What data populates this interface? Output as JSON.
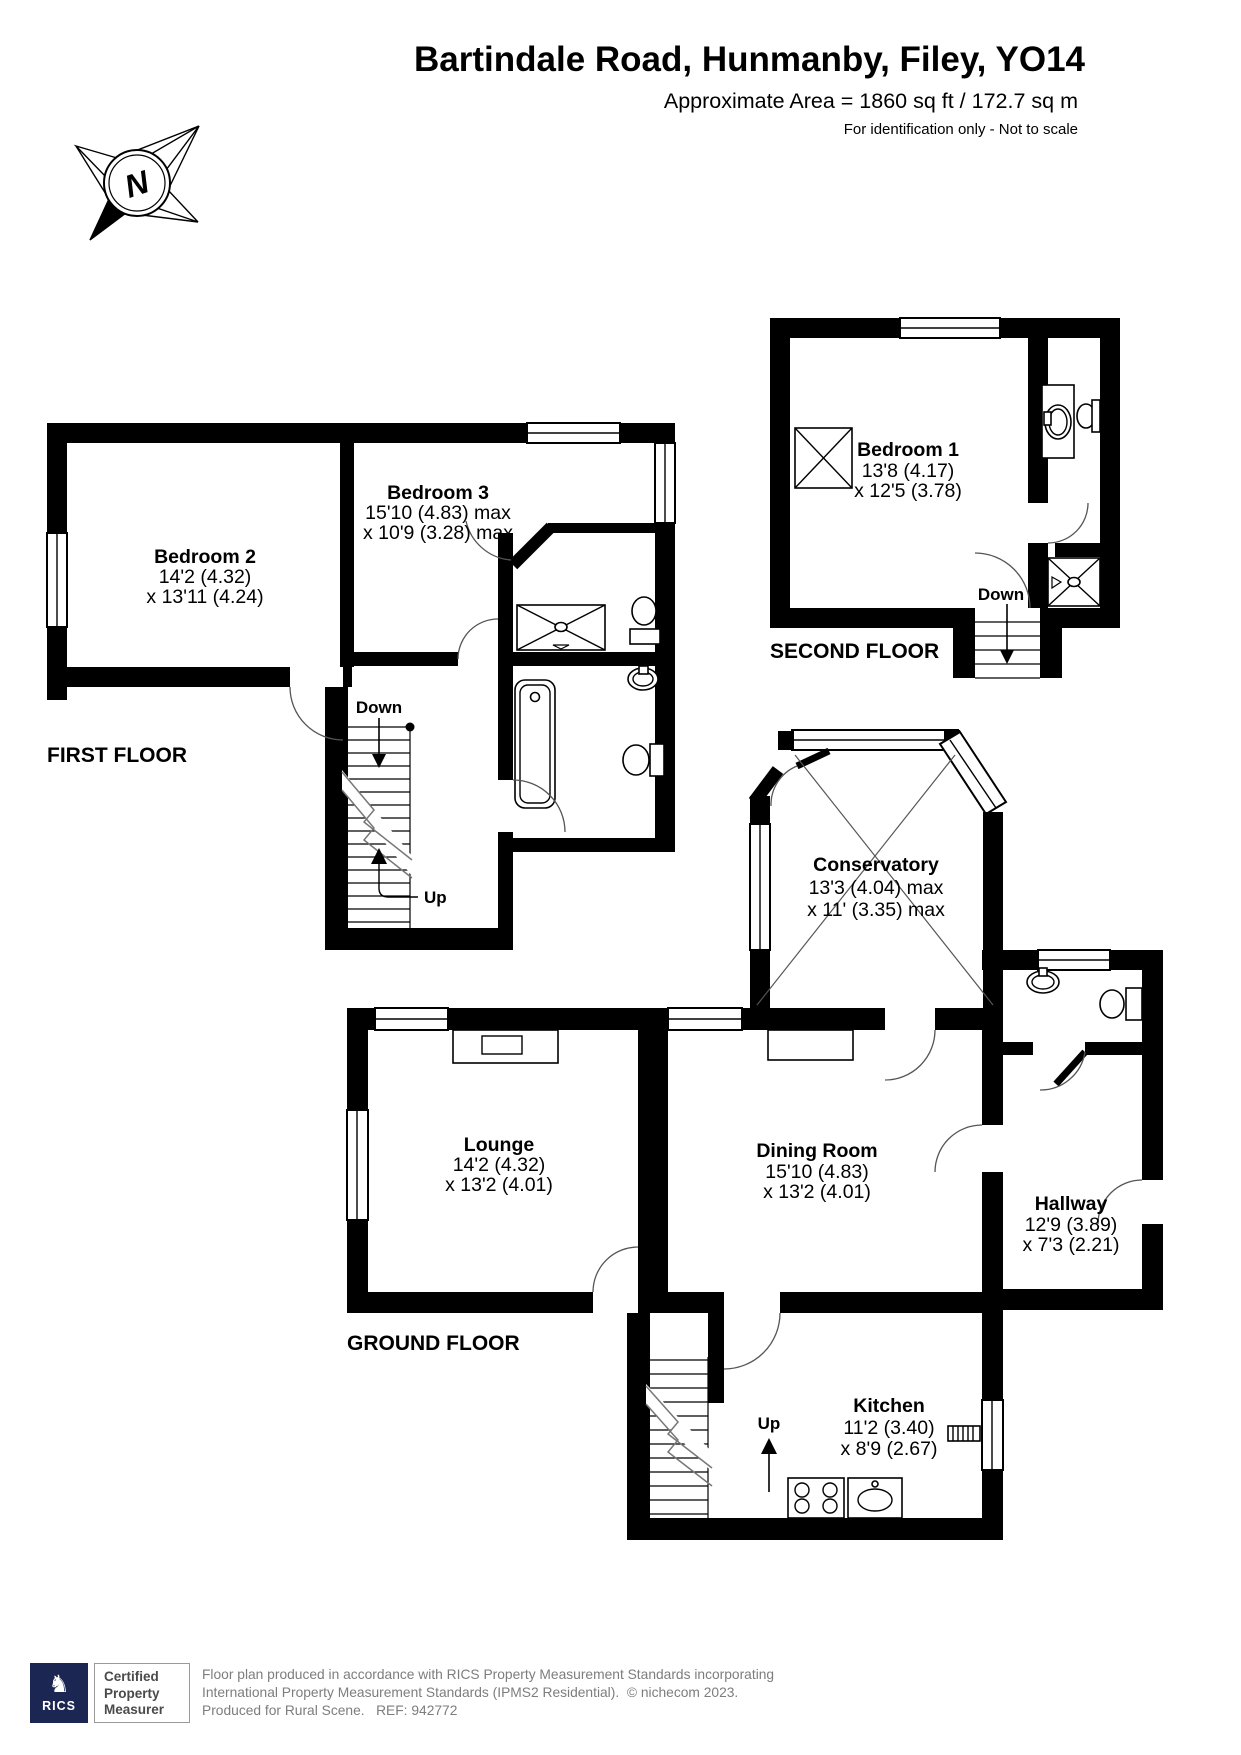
{
  "header": {
    "title": "Bartindale Road, Hunmanby, Filey, YO14",
    "area_line": "Approximate Area = 1860 sq ft / 172.7 sq m",
    "disclaimer": "For identification only - Not to scale"
  },
  "compass": {
    "letter": "N"
  },
  "colors": {
    "wall": "#000000",
    "brand_navy": "#1b2653",
    "footer_text": "#7d7d7d"
  },
  "floors": {
    "second": {
      "label": "SECOND FLOOR",
      "down_label": "Down",
      "bedroom1": {
        "name": "Bedroom 1",
        "dim1": "13'8 (4.17)",
        "dim2": "x 12'5 (3.78)"
      }
    },
    "first": {
      "label": "FIRST FLOOR",
      "down_label": "Down",
      "up_label": "Up",
      "bedroom2": {
        "name": "Bedroom 2",
        "dim1": "14'2 (4.32)",
        "dim2": "x 13'11 (4.24)"
      },
      "bedroom3": {
        "name": "Bedroom 3",
        "dim1": "15'10 (4.83) max",
        "dim2": "x 10'9 (3.28) max"
      }
    },
    "ground": {
      "label": "GROUND FLOOR",
      "up_label": "Up",
      "conservatory": {
        "name": "Conservatory",
        "dim1": "13'3 (4.04) max",
        "dim2": "x 11' (3.35) max"
      },
      "lounge": {
        "name": "Lounge",
        "dim1": "14'2 (4.32)",
        "dim2": "x 13'2 (4.01)"
      },
      "dining_room": {
        "name": "Dining Room",
        "dim1": "15'10 (4.83)",
        "dim2": "x 13'2 (4.01)"
      },
      "hallway": {
        "name": "Hallway",
        "dim1": "12'9 (3.89)",
        "dim2": "x 7'3 (2.21)"
      },
      "kitchen": {
        "name": "Kitchen",
        "dim1": "11'2 (3.40)",
        "dim2": "x 8'9 (2.67)"
      }
    }
  },
  "footer": {
    "logo_text": "RICS",
    "badge_lines": [
      "Certified",
      "Property",
      "Measurer"
    ],
    "line1": "Floor plan produced in accordance with RICS Property Measurement Standards incorporating",
    "line2": "International Property Measurement Standards (IPMS2 Residential).  © nichecom 2023.",
    "line3": "Produced for Rural Scene.   REF: 942772"
  }
}
